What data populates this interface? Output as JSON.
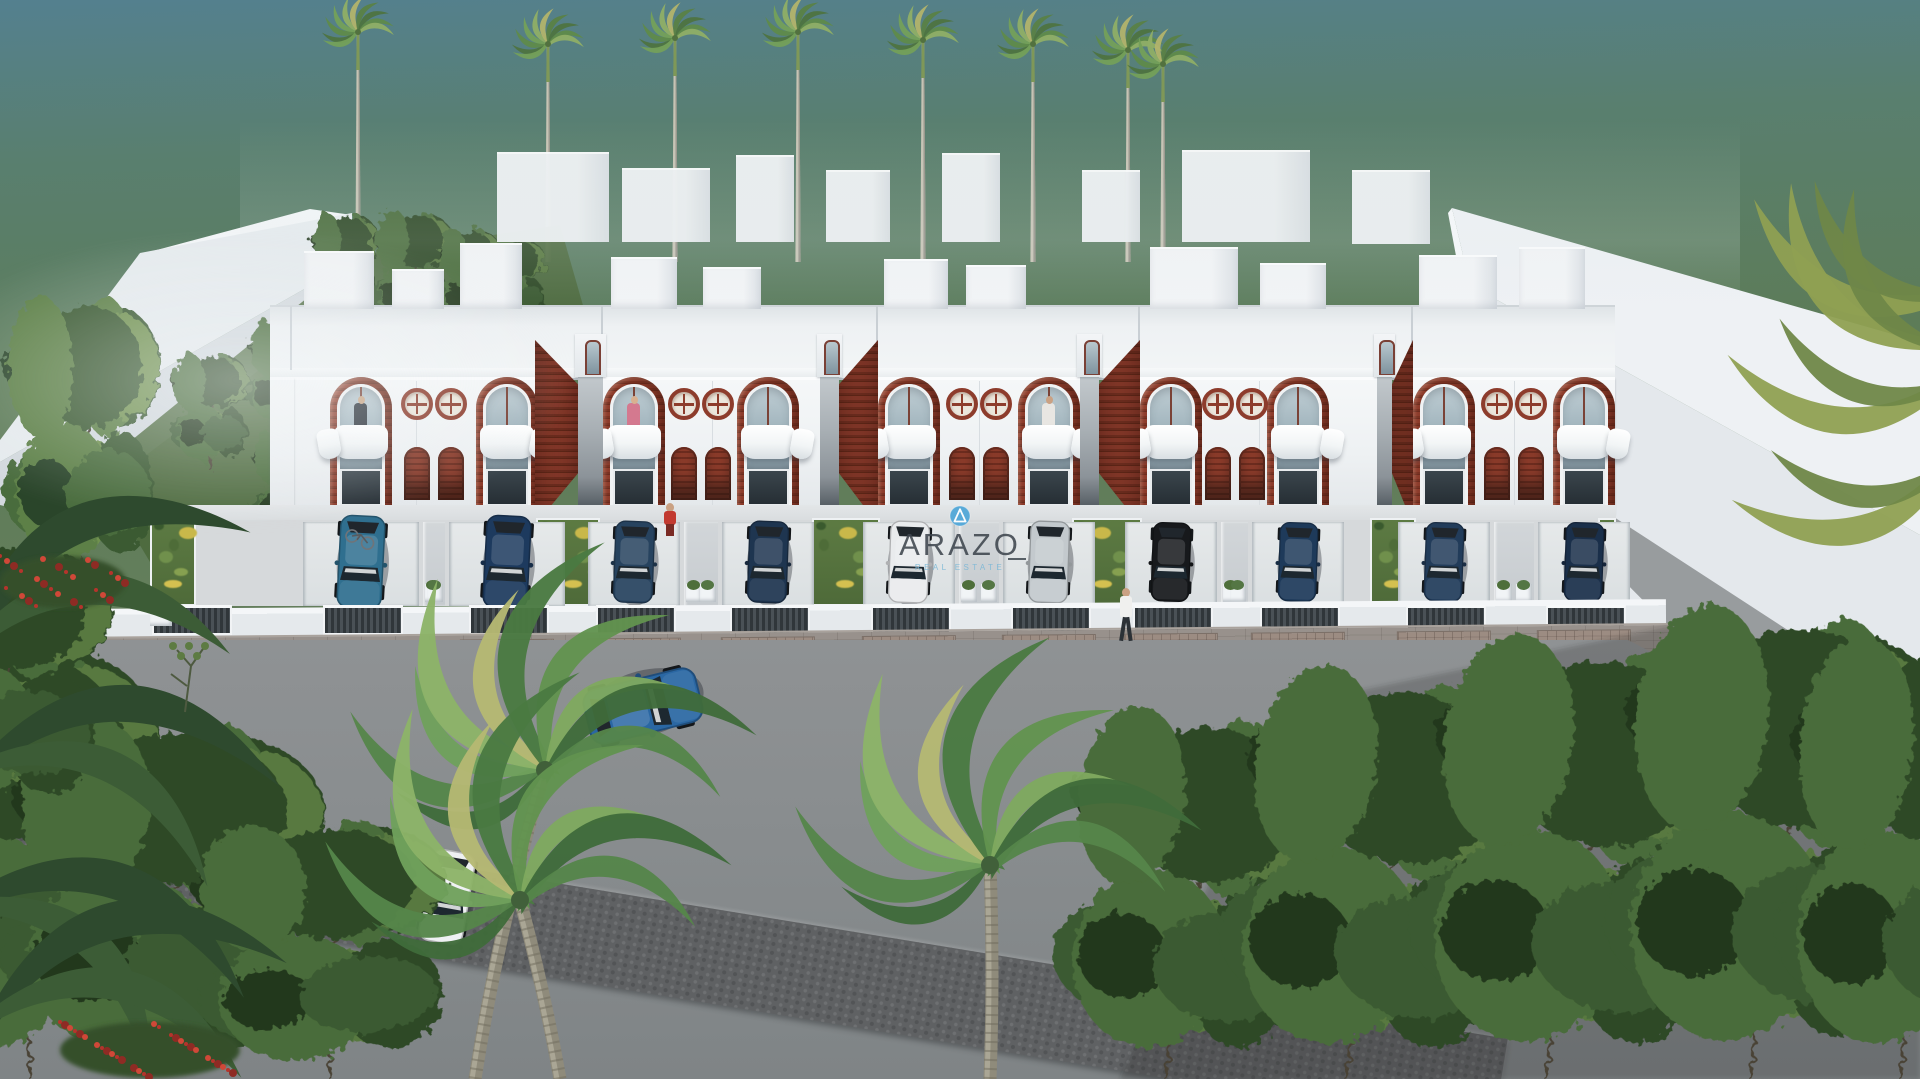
{
  "watermark": {
    "brand": "ARAZO",
    "tagline": "REAL ESTATE",
    "logo": "letter-A-in-circle",
    "logo_color": "#4fa6d8",
    "brand_color": "#3e464e",
    "tagline_color": "#7ab7d6"
  },
  "scene": {
    "description": "Aerial 3D architectural rendering of a row of white two-storey townhouses with dark timber arched panels, round porthole windows, curved white balconies, driveways with parked cars, palm trees behind and tropical trees in the foreground street",
    "palette": {
      "sky_top": "#54808f",
      "sky_green": "#5d7c58",
      "white_lit": "#f3f5f7",
      "white_shade": "#d9dee2",
      "timber": "#8d3c2b",
      "timber_dark": "#6c2c1e",
      "glass": "#9db1ba",
      "road": "#898d8f",
      "cobble": "#5f6163",
      "lawn": "#55743c",
      "gate": "#3c4246",
      "paver": "#958e8a"
    },
    "rear_palms": [
      {
        "x": 358,
        "h": 238
      },
      {
        "x": 548,
        "h": 226
      },
      {
        "x": 675,
        "h": 232
      },
      {
        "x": 798,
        "h": 238
      },
      {
        "x": 923,
        "h": 230
      },
      {
        "x": 1033,
        "h": 226
      },
      {
        "x": 1128,
        "h": 220
      },
      {
        "x": 1163,
        "h": 206
      }
    ],
    "background_boxes": [
      {
        "x": 497,
        "w": 112,
        "y": 152,
        "h": 88
      },
      {
        "x": 622,
        "w": 88,
        "y": 168,
        "h": 72
      },
      {
        "x": 736,
        "w": 58,
        "y": 155,
        "h": 85
      },
      {
        "x": 826,
        "w": 64,
        "y": 170,
        "h": 70
      },
      {
        "x": 942,
        "w": 58,
        "y": 153,
        "h": 87
      },
      {
        "x": 1082,
        "w": 58,
        "y": 170,
        "h": 70
      },
      {
        "x": 1182,
        "w": 128,
        "y": 150,
        "h": 90
      },
      {
        "x": 1352,
        "w": 78,
        "y": 170,
        "h": 72
      }
    ],
    "blocks": [
      {
        "x": 292,
        "w": 248,
        "archA": 38,
        "archB": 184,
        "bulks": [
          [
            12,
            70,
            56
          ],
          [
            100,
            52,
            38
          ],
          [
            168,
            62,
            64
          ]
        ]
      },
      {
        "x": 603,
        "w": 217,
        "archA": 0,
        "archB": 134,
        "bulks": [
          [
            8,
            66,
            50
          ],
          [
            100,
            58,
            40
          ]
        ]
      },
      {
        "x": 878,
        "w": 202,
        "archA": 0,
        "archB": 140,
        "bulks": [
          [
            6,
            64,
            48
          ],
          [
            88,
            60,
            42
          ]
        ]
      },
      {
        "x": 1140,
        "w": 237,
        "archA": 0,
        "archB": 127,
        "bulks": [
          [
            10,
            88,
            60
          ],
          [
            120,
            66,
            44
          ]
        ]
      },
      {
        "x": 1413,
        "w": 202,
        "archA": 0,
        "archB": 140,
        "bulks": [
          [
            6,
            78,
            52
          ],
          [
            106,
            66,
            60
          ]
        ]
      }
    ],
    "arch_w": 62,
    "gaps": [
      {
        "x": 535,
        "passage": [
          43,
          68
        ],
        "plane": [
          0,
          43
        ],
        "near": "left"
      },
      {
        "x": 820,
        "passage": [
          0,
          19
        ],
        "plane": [
          19,
          58
        ],
        "near": "right"
      },
      {
        "x": 1080,
        "passage": [
          0,
          19
        ],
        "plane": [
          19,
          60
        ],
        "near": "right"
      },
      {
        "x": 1377,
        "passage": [
          0,
          15
        ],
        "plane": [
          15,
          36
        ],
        "near": "right"
      }
    ],
    "yard_cars": [
      "#2f6f8f",
      "#1d3a5e",
      "#27435f",
      "#1e3550",
      "#e9ebed",
      "#c3c9cd",
      "#17191c",
      "#1e3a5a",
      "#223c5a",
      "#1a2f4a"
    ],
    "road_cars": [
      {
        "x": 643,
        "y": 706,
        "rot": -104,
        "scale": 1.25,
        "body": "#2a67a3",
        "roof": "#6fa8d8"
      },
      {
        "x": 447,
        "y": 897,
        "rot": 10,
        "scale": 1.0,
        "body": "#eef0f2",
        "roof": "#2a4d7e"
      }
    ],
    "balcony_people": [
      {
        "block": 0,
        "unit": "A",
        "shirt": "#2c333b",
        "head": "#c9a584"
      },
      {
        "block": 1,
        "unit": "A",
        "shirt": "#d4798f",
        "head": "#d8b090"
      },
      {
        "block": 2,
        "unit": "B",
        "shirt": "#e8e6e2",
        "head": "#caa183"
      }
    ],
    "street_people": [
      {
        "x": 1117,
        "y": 588,
        "shirt": "#f0f0ee",
        "pants": "#2c3136",
        "kind": "walking"
      },
      {
        "x": 661,
        "y": 503,
        "shirt": "#c23a30",
        "pants": "#7a2b24",
        "kind": "standing"
      }
    ],
    "right_trees": [
      {
        "x": 1165,
        "base": 1079,
        "w": 260,
        "h": 470,
        "lean": 7
      },
      {
        "x": 1345,
        "base": 1079,
        "w": 300,
        "h": 520,
        "lean": 9
      },
      {
        "x": 1545,
        "base": 1079,
        "w": 320,
        "h": 560,
        "lean": 8
      },
      {
        "x": 1750,
        "base": 1079,
        "w": 330,
        "h": 600,
        "lean": 6
      },
      {
        "x": 1900,
        "base": 1079,
        "w": 280,
        "h": 560,
        "lean": 5
      }
    ],
    "slope_trees": [
      {
        "x": 345,
        "base": 330,
        "w": 70,
        "h": 150,
        "lean": 0
      },
      {
        "x": 410,
        "base": 335,
        "w": 80,
        "h": 160,
        "lean": 2
      },
      {
        "x": 470,
        "base": 330,
        "w": 64,
        "h": 130,
        "lean": 0
      },
      {
        "x": 520,
        "base": 325,
        "w": 56,
        "h": 110,
        "lean": -2
      },
      {
        "x": 210,
        "base": 470,
        "w": 80,
        "h": 150,
        "lean": 0
      },
      {
        "x": 280,
        "base": 430,
        "w": 70,
        "h": 140,
        "lean": 2
      },
      {
        "x": 350,
        "base": 470,
        "w": 90,
        "h": 150,
        "lean": 0
      },
      {
        "x": 420,
        "base": 520,
        "w": 90,
        "h": 150,
        "lean": -2
      },
      {
        "x": 300,
        "base": 545,
        "w": 100,
        "h": 150,
        "lean": 0
      }
    ]
  }
}
